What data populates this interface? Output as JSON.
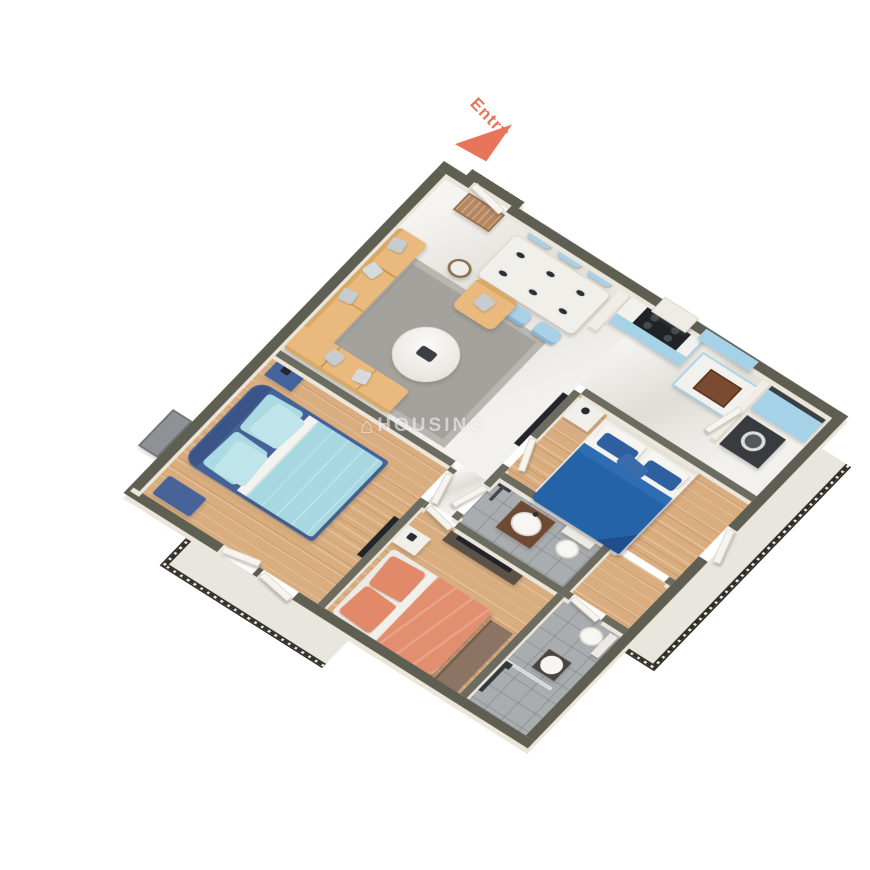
{
  "scene": {
    "entry_label": "Entry",
    "watermark": "HOUSING",
    "watermark_icon": "⌂"
  },
  "palette": {
    "wall_cap_ext": "#5f5e52",
    "wall_cap_int": "#6c6b60",
    "wall_face": "#ece6da",
    "floor_marble": "#eae8e3",
    "floor_wood": "#d9ad7e",
    "floor_tile": "#a9adaf",
    "floor_balcony": "#e9e6df",
    "cabinet_blue": "#a6d2e8",
    "chair_blue": "#a9d0e6",
    "sofa_tan": "#e9b97d",
    "rug_gray": "#a4a29c",
    "bed_master": "#2563a8",
    "bed2_duvet": "#a7d7e0",
    "bed2_frame": "#45639b",
    "bed3_coral": "#e28f70",
    "door_white": "#f6f4ef",
    "railing": "#2f2c25",
    "appliance": "#383b40",
    "entry_accent": "#e8745a",
    "watermark": "rgba(255,255,255,0.55)"
  }
}
